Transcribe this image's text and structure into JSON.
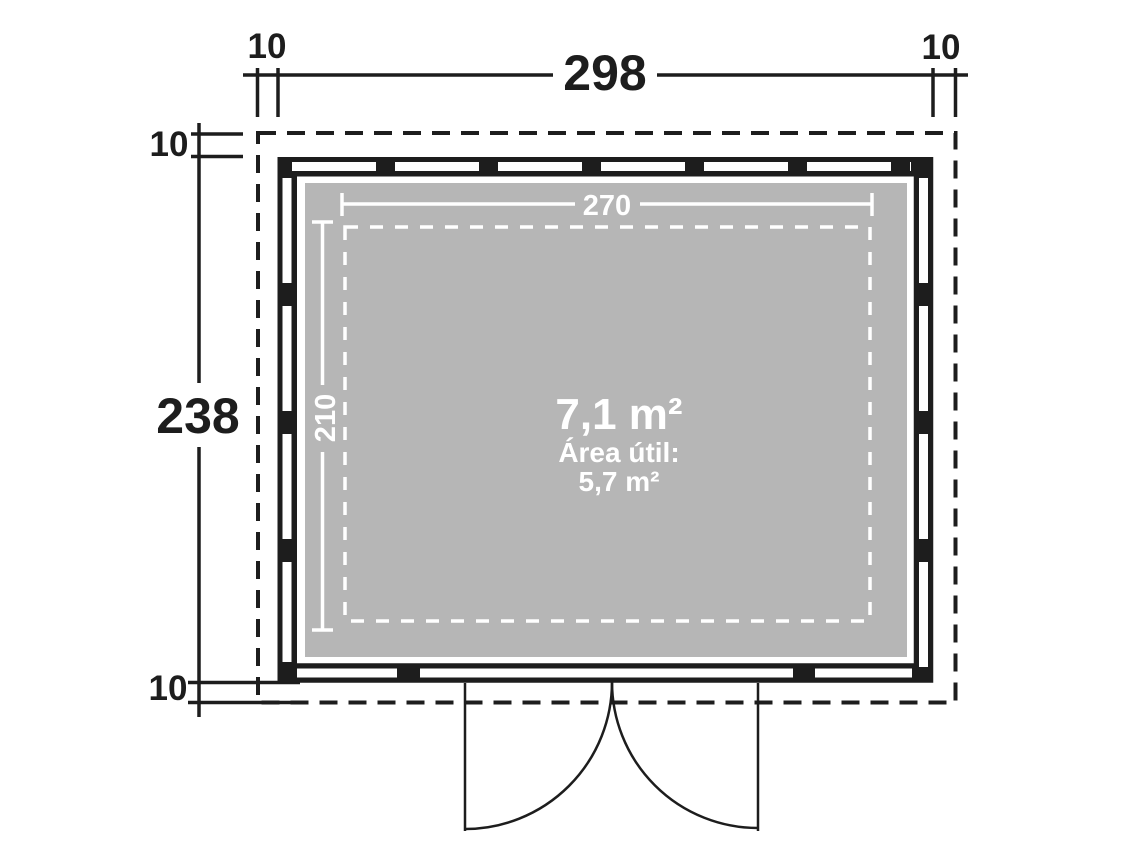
{
  "plan": {
    "overall": {
      "width": "298",
      "depth": "238"
    },
    "overhangs": {
      "top_left": "10",
      "top_right": "10",
      "left_top": "10",
      "left_bottom": "10"
    },
    "interior": {
      "width": "270",
      "depth": "210"
    },
    "area": {
      "gross": "7,1 m²",
      "net_caption": "Área útil:",
      "net_value": "5,7 m²"
    },
    "colors": {
      "line": "#1d1d1d",
      "floor": "#b6b6b6",
      "interior_text": "#ffffff",
      "background": "#ffffff"
    }
  }
}
